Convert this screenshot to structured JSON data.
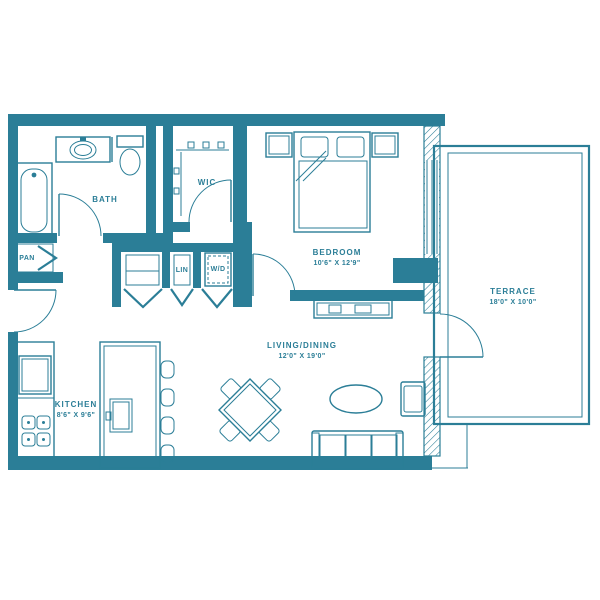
{
  "colors": {
    "line": "#2b7e97",
    "background": "#ffffff"
  },
  "plan": {
    "bath": {
      "label": "BATH"
    },
    "pantry": {
      "label": "PAN"
    },
    "walk_in_closet": {
      "label": "WIC"
    },
    "linen": {
      "label": "LIN"
    },
    "washer_dryer": {
      "label": "W/D"
    },
    "bedroom": {
      "label": "BEDROOM",
      "dims": "10'6\" X 12'9\""
    },
    "living_dining": {
      "label": "LIVING/DINING",
      "dims": "12'0\" X 19'0\""
    },
    "kitchen": {
      "label": "KITCHEN",
      "dims": "8'6\" X 9'6\""
    },
    "terrace": {
      "label": "TERRACE",
      "dims": "18'0\" X 10'0\""
    }
  }
}
